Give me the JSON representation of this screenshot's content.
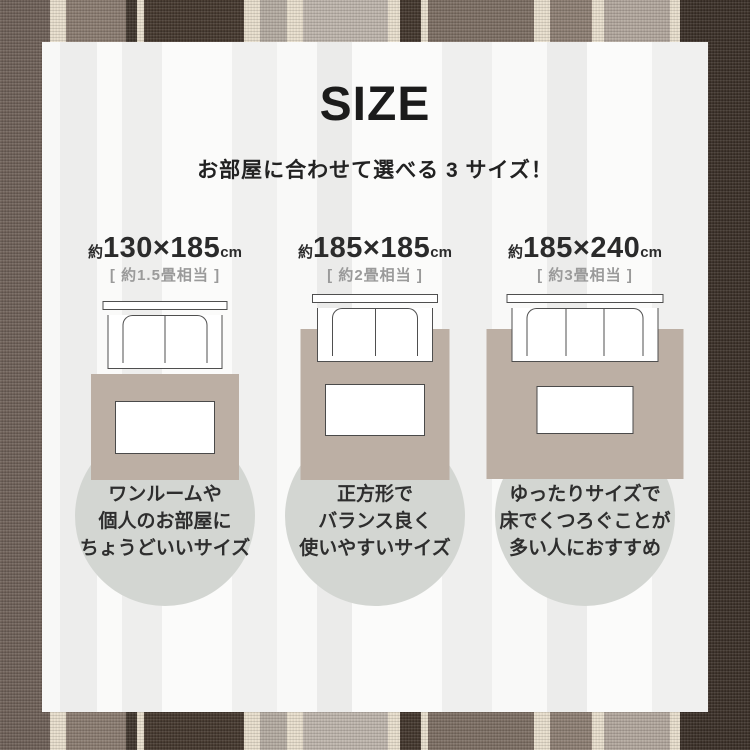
{
  "header": {
    "title": "SIZE",
    "subtitle": "お部屋に合わせて選べる 3 サイズ！"
  },
  "sizes": [
    {
      "size_prefix": "約",
      "size_value": "130×185",
      "size_unit": "cm",
      "tatami": "[ 約1.5畳相当 ]",
      "seats": 2,
      "desc_lines": [
        "ワンルームや",
        "個人のお部屋に",
        "ちょうどいいサイズ"
      ]
    },
    {
      "size_prefix": "約",
      "size_value": "185×185",
      "size_unit": "cm",
      "tatami": "[ 約2畳相当 ]",
      "seats": 2,
      "desc_lines": [
        "正方形で",
        "バランス良く",
        "使いやすいサイズ"
      ]
    },
    {
      "size_prefix": "約",
      "size_value": "185×240",
      "size_unit": "cm",
      "tatami": "[ 約3畳相当 ]",
      "seats": 3,
      "desc_lines": [
        "ゆったりサイズで",
        "床でくつろぐことが",
        "多い人におすすめ"
      ]
    }
  ],
  "colors": {
    "rug": "#bcafa4",
    "circle": "#d3d6d2",
    "outline": "#4f4f4f",
    "stripe_dark_brown": "#3a2f27",
    "stripe_medium_brown": "#6e6057",
    "stripe_cream": "#e9dfcd",
    "stripe_light_taupe": "#b2a79d"
  }
}
